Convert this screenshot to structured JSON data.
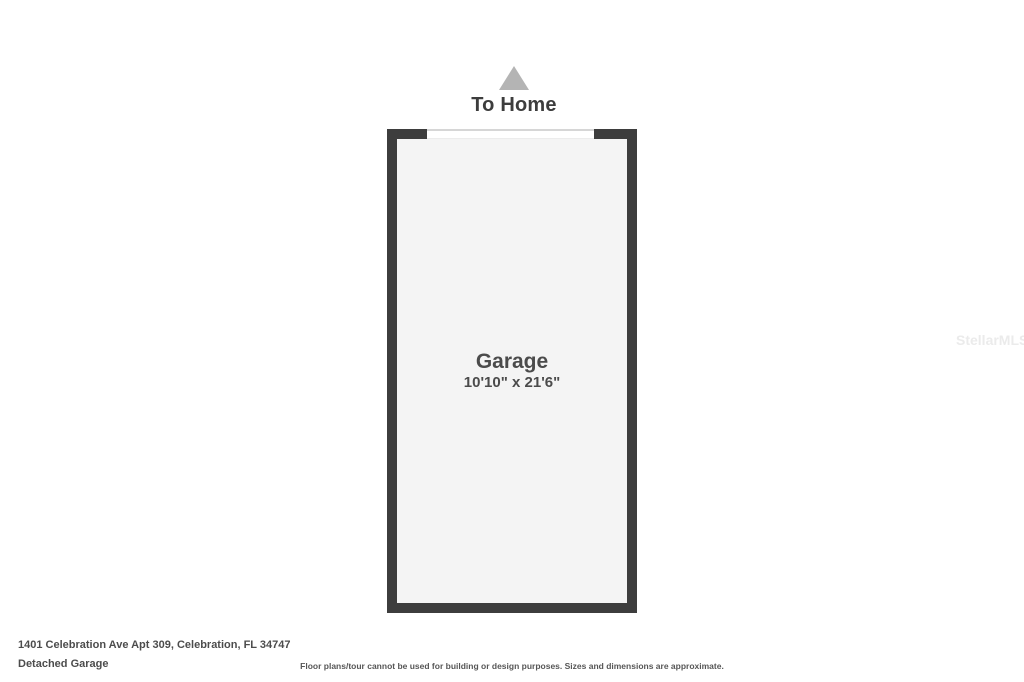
{
  "page": {
    "background": "#ffffff"
  },
  "to_home": {
    "label": "To Home",
    "arrow_icon": "up-triangle-icon",
    "arrow_color": "#b4b4b4"
  },
  "floor_plan": {
    "room": {
      "name": "Garage",
      "dimensions": "10'10\" x 21'6\""
    },
    "features": {
      "garage_door_opening": "top wall opening between wall segments"
    },
    "colors": {
      "wall": "#3d3d3d",
      "floor": "#f4f4f4",
      "door_opening": "#ffffff"
    }
  },
  "footer": {
    "address": "1401 Celebration Ave Apt 309, Celebration, FL 34747",
    "plan_title": "Detached Garage",
    "disclaimer": "Floor plans/tour cannot be used for building or design purposes. Sizes and dimensions are approximate."
  },
  "watermark": {
    "text": "StellarMLS",
    "color": "#ebebeb"
  }
}
